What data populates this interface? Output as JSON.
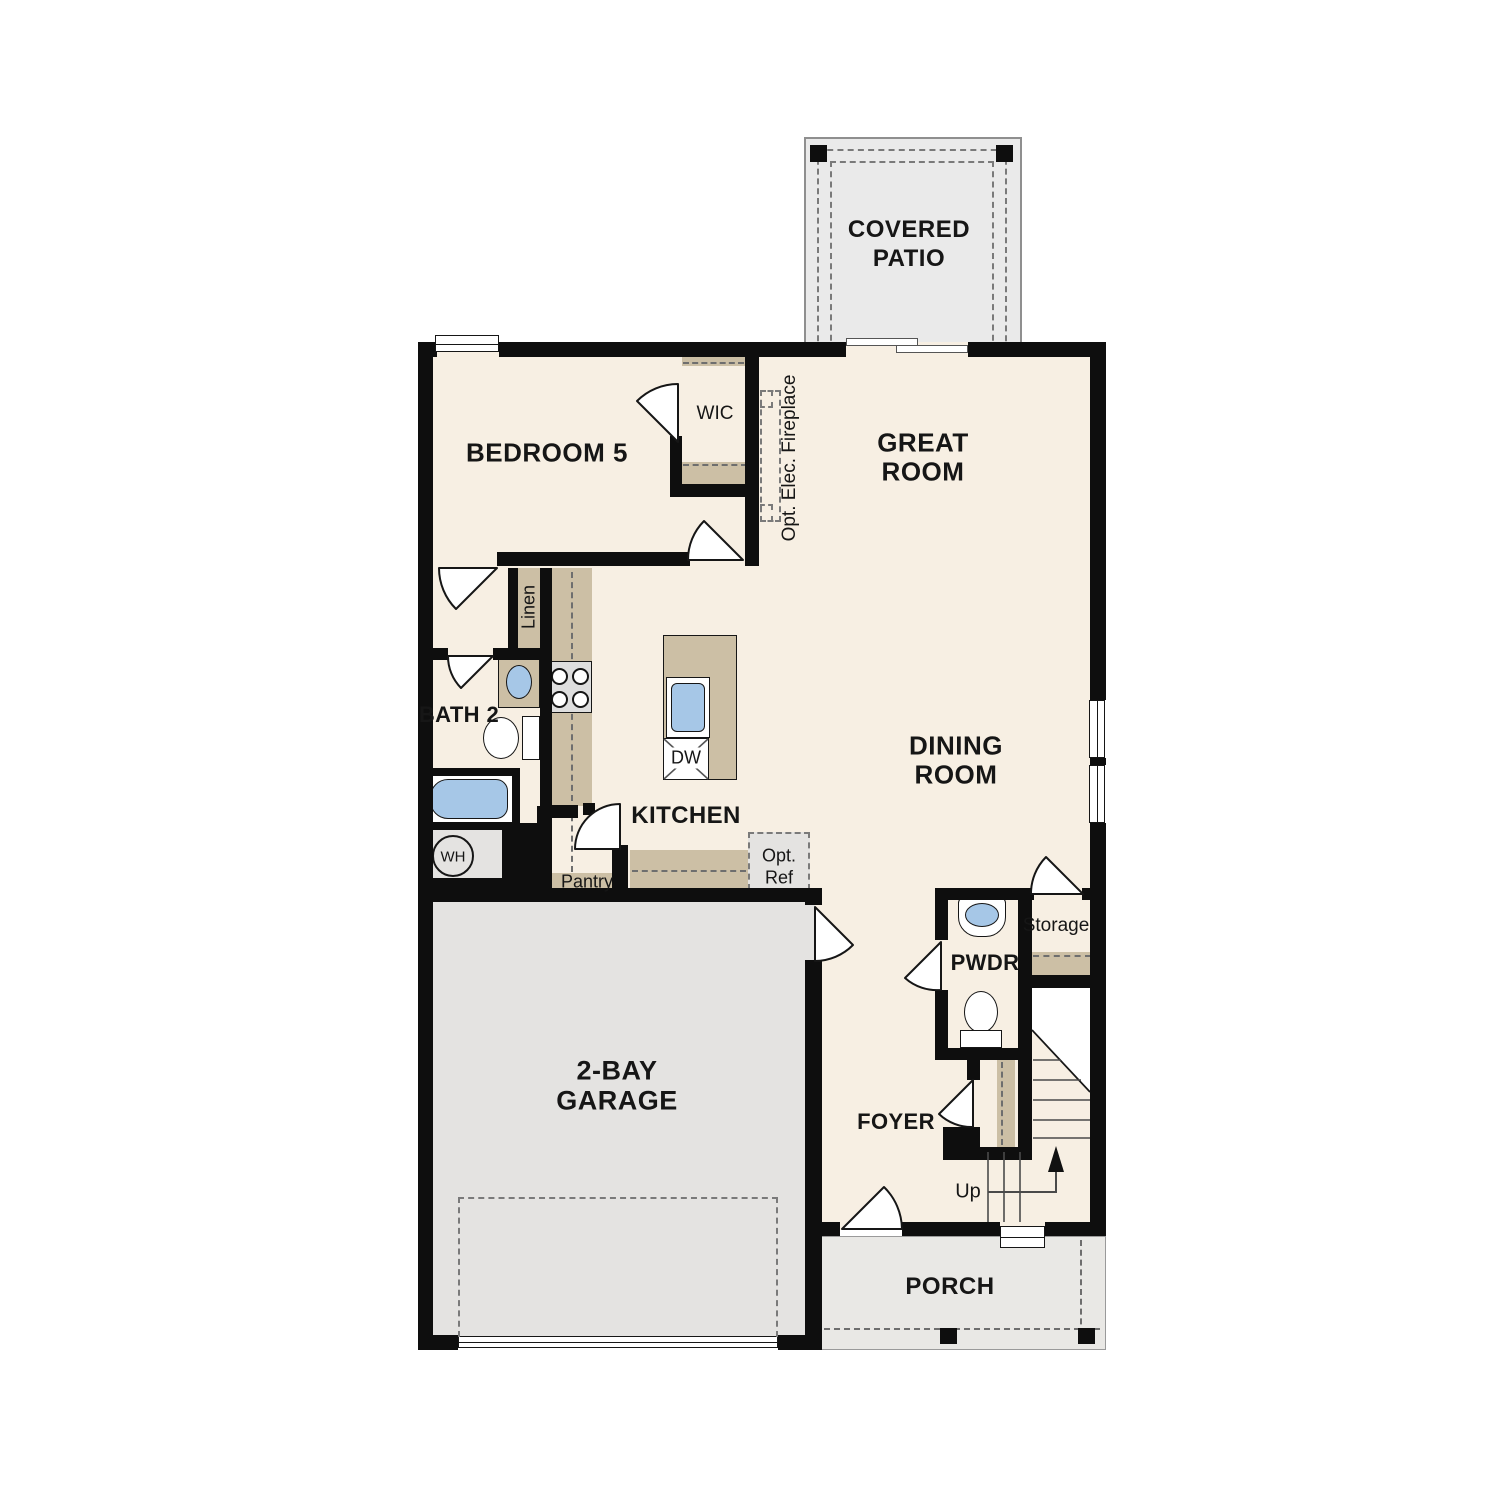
{
  "labels": {
    "covered_patio_1": "COVERED",
    "covered_patio_2": "PATIO",
    "bedroom5": "BEDROOM 5",
    "wic": "WIC",
    "great_room_1": "GREAT",
    "great_room_2": "ROOM",
    "opt_fireplace": "Opt. Elec. Fireplace",
    "linen": "Linen",
    "bath2": "BATH 2",
    "dining_1": "DINING",
    "dining_2": "ROOM",
    "kitchen": "KITCHEN",
    "dw": "DW",
    "pantry": "Pantry",
    "opt_ref_1": "Opt.",
    "opt_ref_2": "Ref",
    "wh": "WH",
    "garage_1": "2-BAY",
    "garage_2": "GARAGE",
    "pwdr": "PWDR",
    "storage": "Storage",
    "foyer": "FOYER",
    "up": "Up",
    "porch": "PORCH"
  },
  "colors": {
    "floor": "#f7efe3",
    "garage_floor": "#e4e3e1",
    "patio_floor": "#eaeaea",
    "porch_floor": "#e9e8e5",
    "cabinet_tan": "#ccbfa5",
    "fixture_blue": "#a6c7e7",
    "appliance_gray": "#dedede",
    "wall": "#0e0e0e"
  }
}
